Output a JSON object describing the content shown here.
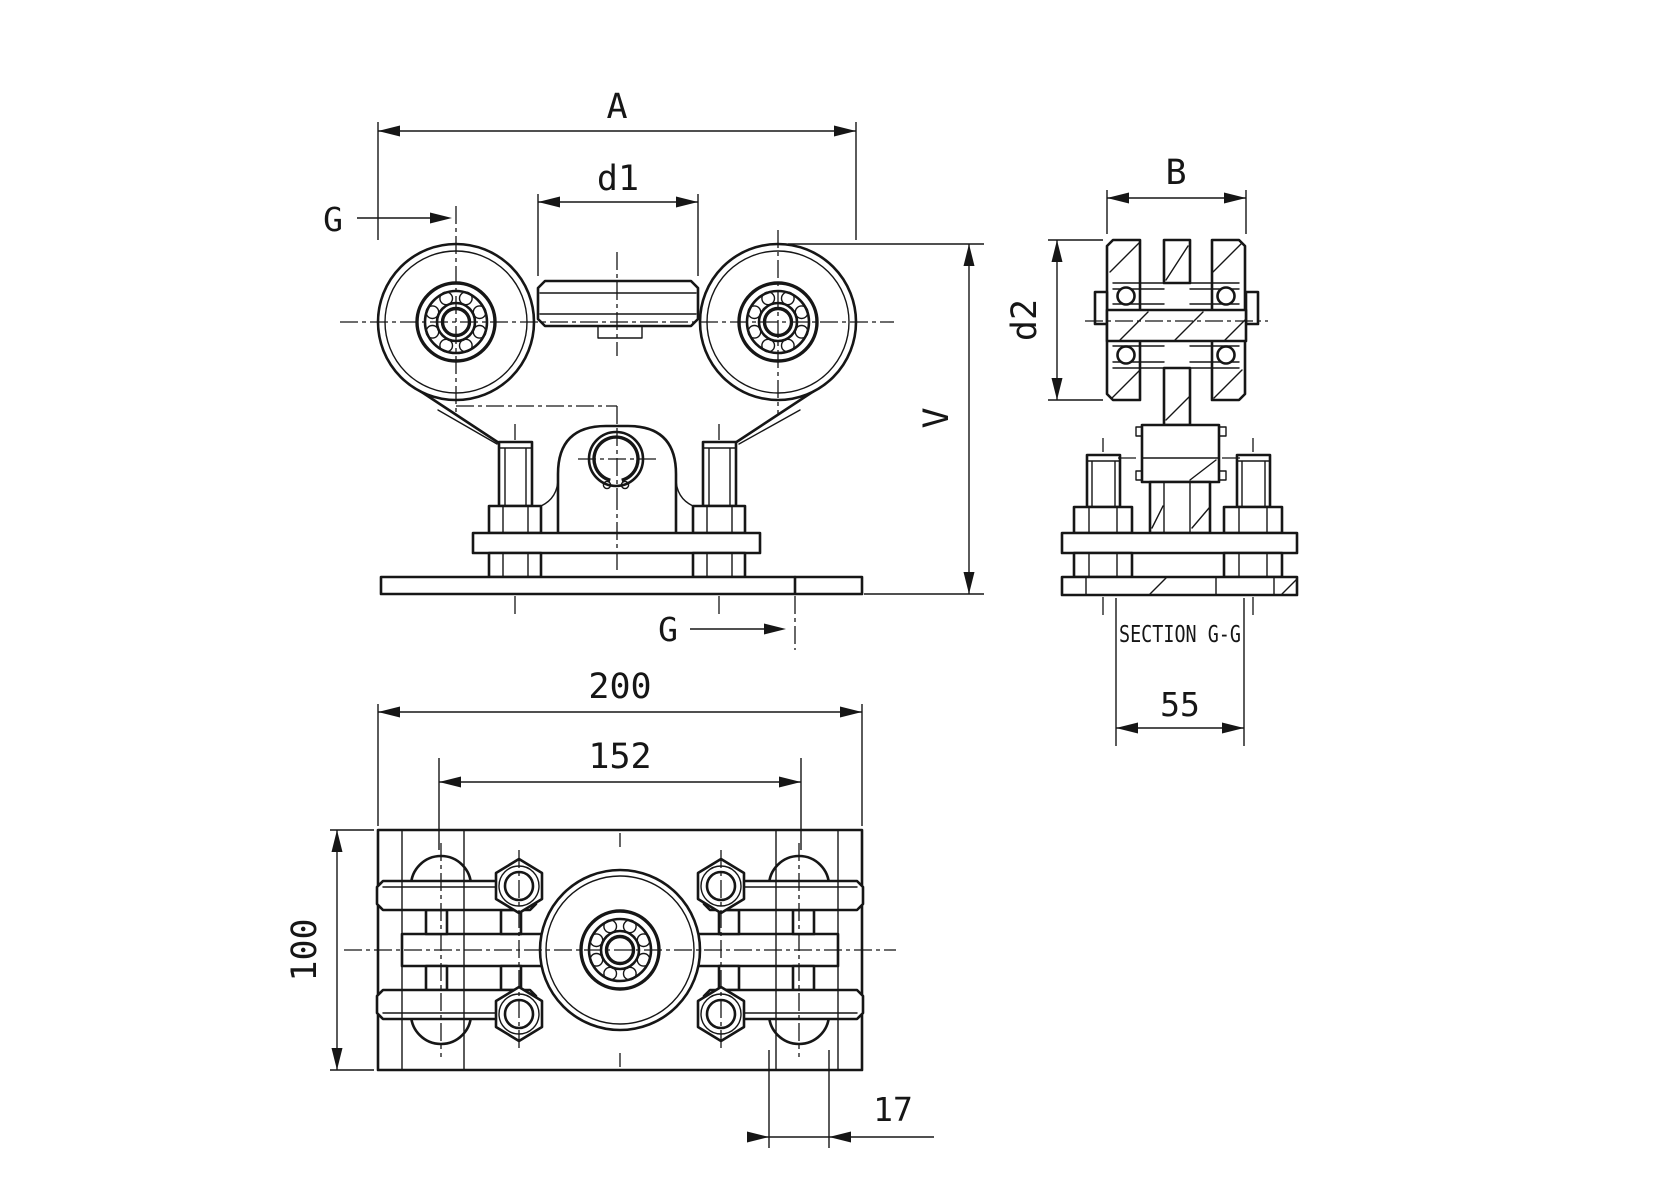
{
  "drawing": {
    "background": "#ffffff",
    "line_color": "#161616",
    "front_view": {
      "dim_overall_width_label": "A",
      "dim_spacer_width_label": "d1",
      "section_cut_label_top": "G",
      "section_cut_label_bottom": "G",
      "dim_overall_height_label": "V"
    },
    "section_view": {
      "dim_wheel_width_label": "B",
      "dim_wheel_diameter_label": "d2",
      "caption": "SECTION G-G",
      "dim_base_width_value": "55"
    },
    "plan_view": {
      "dim_overall_length_value": "200",
      "dim_axle_spacing_value": "152",
      "dim_overall_depth_value": "100",
      "dim_roller_end_value": "17"
    }
  }
}
